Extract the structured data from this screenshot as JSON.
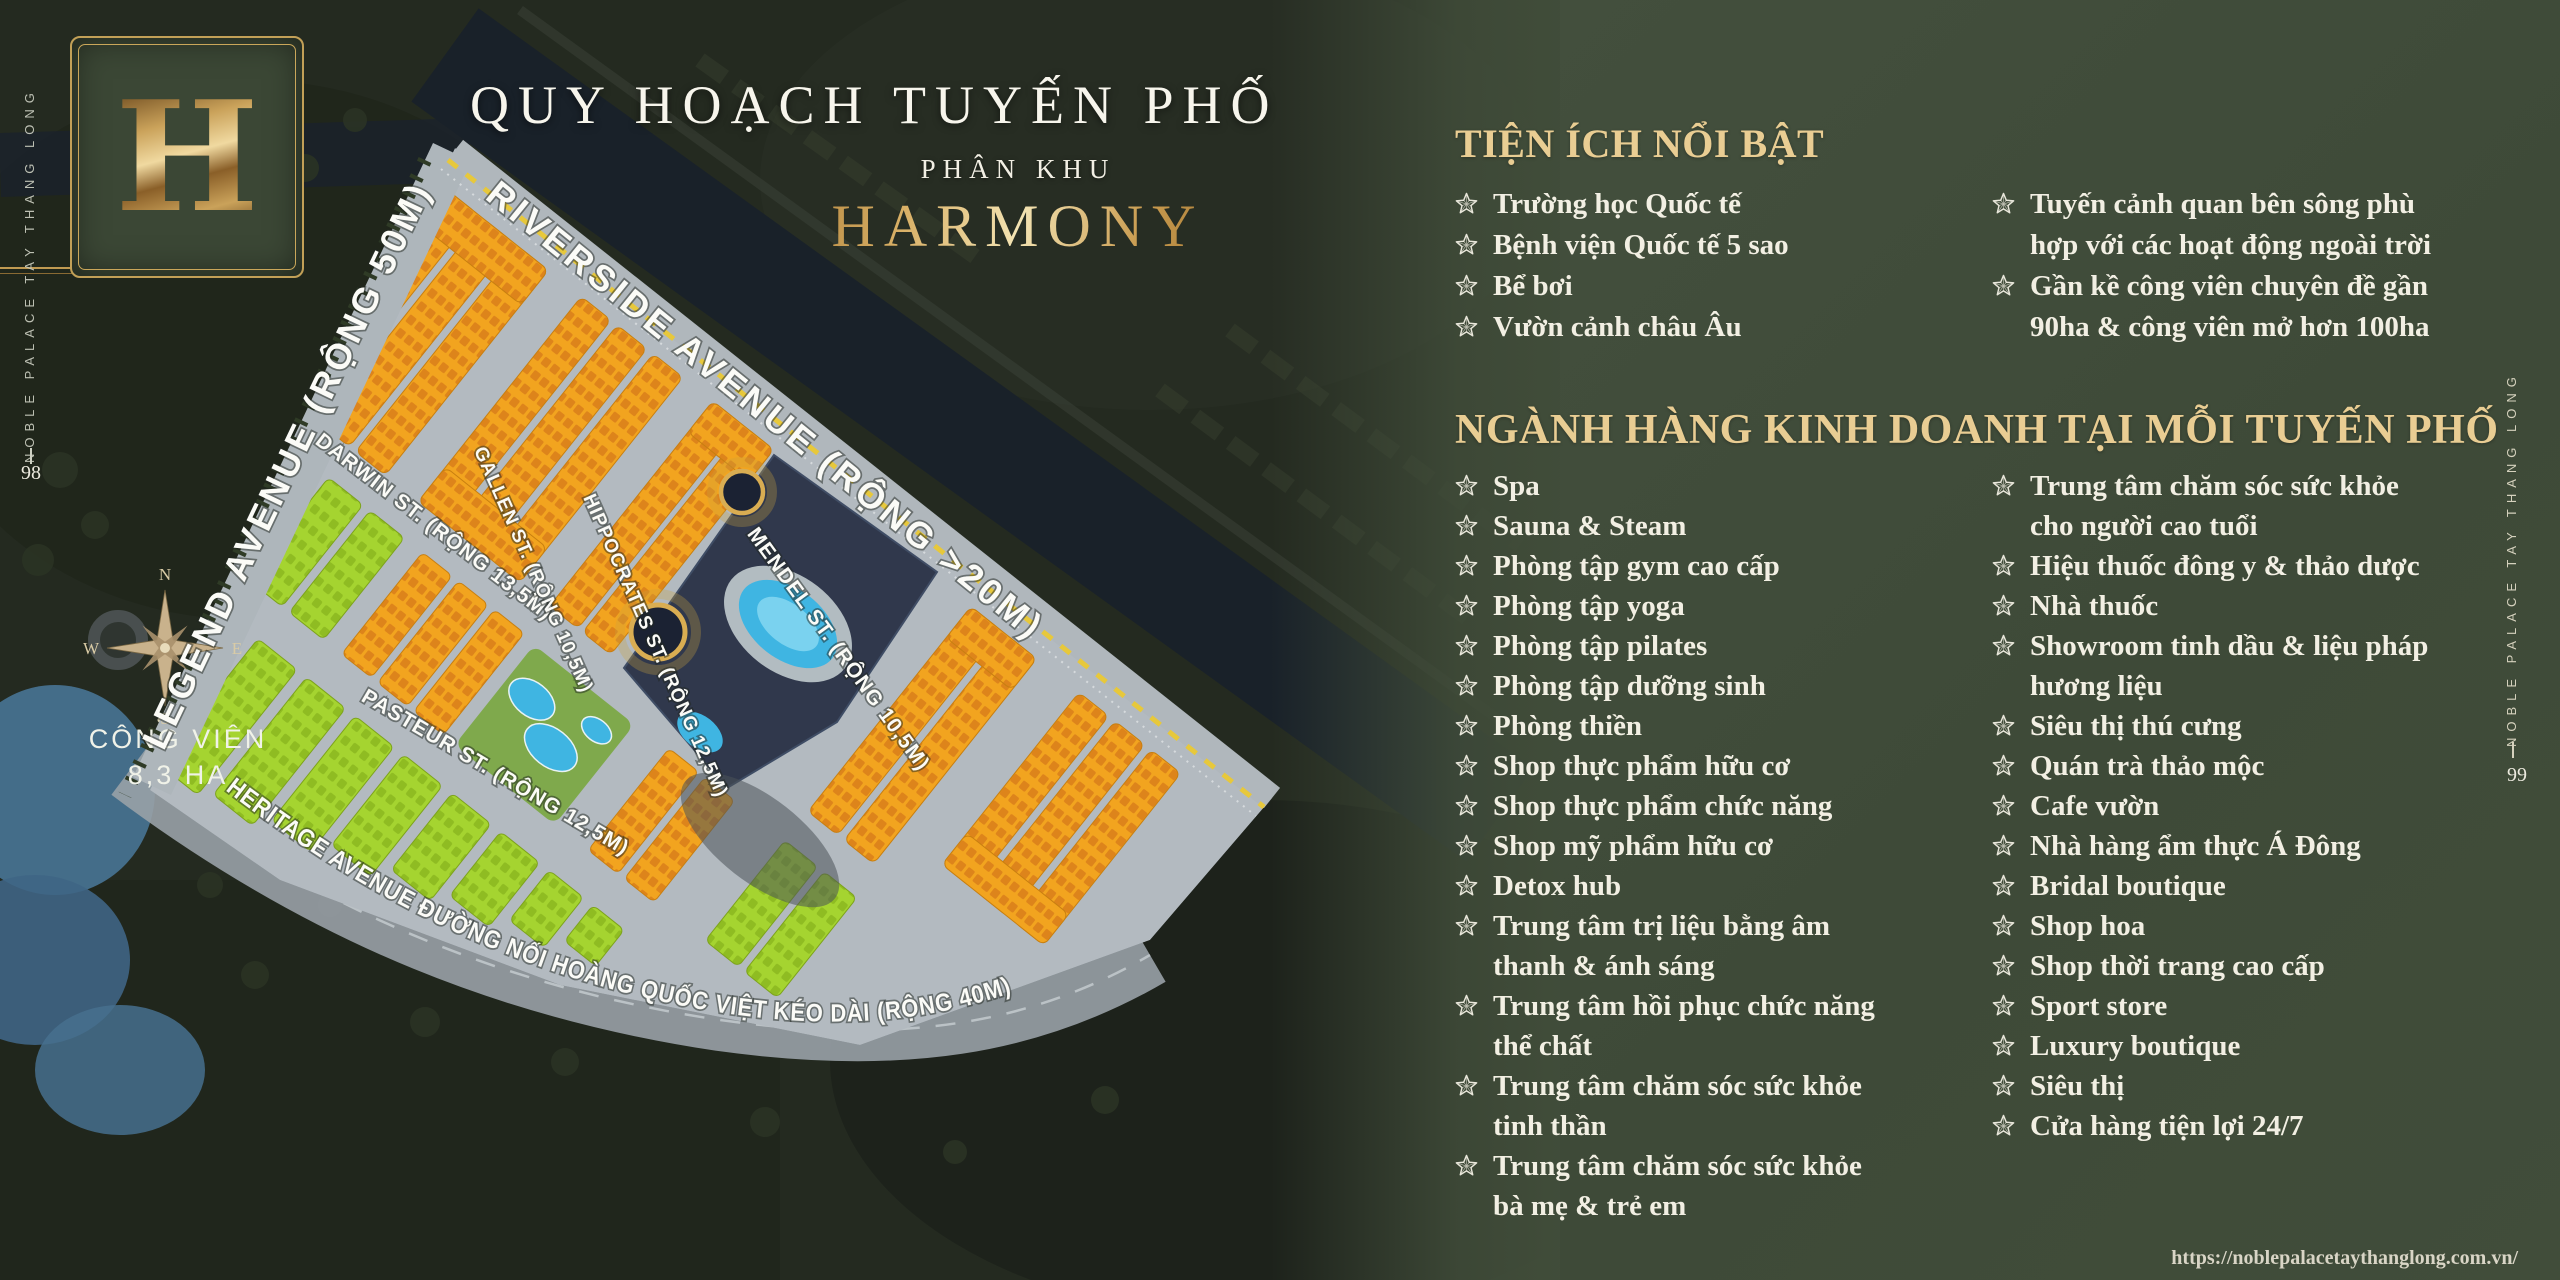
{
  "page": {
    "left_page_number": "98",
    "right_page_number": "99",
    "side_label": "NOBLE PALACE TAY THANG LONG",
    "footer_url": "https://noblepalacetaythanglong.com.vn/"
  },
  "logo": {
    "letter": "H"
  },
  "title": {
    "main": "QUY HOẠCH TUYẾN PHỐ",
    "sub": "PHÂN KHU",
    "zone": "HARMONY"
  },
  "amenities": {
    "header": "TIỆN ÍCH NỔI BẬT",
    "col1": [
      [
        "Trường học Quốc tế"
      ],
      [
        "Bệnh viện Quốc tế 5 sao"
      ],
      [
        "Bể bơi"
      ],
      [
        "Vườn cảnh châu Âu"
      ]
    ],
    "col2": [
      [
        "Tuyến cảnh quan bên sông phù",
        "hợp với các hoạt động ngoài trời"
      ],
      [
        "Gần kề công viên chuyên đề gần",
        "90ha & công viên mở hơn 100ha"
      ]
    ]
  },
  "business": {
    "header": "NGÀNH HÀNG KINH DOANH TẠI MỖI TUYẾN PHỐ",
    "col1": [
      [
        "Spa"
      ],
      [
        "Sauna & Steam"
      ],
      [
        "Phòng tập gym cao cấp"
      ],
      [
        "Phòng tập yoga"
      ],
      [
        "Phòng tập pilates"
      ],
      [
        "Phòng tập dưỡng sinh"
      ],
      [
        "Phòng thiền"
      ],
      [
        "Shop thực phẩm hữu cơ"
      ],
      [
        "Shop thực phẩm chức năng"
      ],
      [
        "Shop mỹ phẩm hữu cơ"
      ],
      [
        "Detox hub"
      ],
      [
        "Trung tâm trị liệu bằng âm",
        "thanh & ánh sáng"
      ],
      [
        "Trung tâm hồi phục chức năng",
        "thể chất"
      ],
      [
        "Trung tâm chăm sóc sức khỏe",
        "tinh thần"
      ],
      [
        "Trung tâm chăm sóc sức khỏe",
        "bà mẹ & trẻ em"
      ]
    ],
    "col2": [
      [
        "Trung tâm chăm sóc sức khỏe",
        "cho người cao tuổi"
      ],
      [
        "Hiệu thuốc đông y & thảo dược"
      ],
      [
        "Nhà thuốc"
      ],
      [
        "Showroom tinh dầu & liệu pháp",
        "hương liệu"
      ],
      [
        "Siêu thị thú cưng"
      ],
      [
        "Quán trà thảo mộc"
      ],
      [
        "Cafe vườn"
      ],
      [
        "Nhà hàng ẩm thực Á Đông"
      ],
      [
        "Bridal boutique"
      ],
      [
        "Shop hoa"
      ],
      [
        "Shop thời trang cao cấp"
      ],
      [
        "Sport store"
      ],
      [
        "Luxury boutique"
      ],
      [
        "Siêu thị"
      ],
      [
        "Cửa hàng tiện lợi 24/7"
      ]
    ]
  },
  "map": {
    "park_label": [
      "CÔNG VIÊN",
      "8,3 HA"
    ],
    "compass": [
      "N",
      "E",
      "S",
      "W"
    ],
    "heritage_label": "HERITAGE AVENUE ĐƯỜNG NỐI HOÀNG QUỐC VIỆT KÉO DÀI (RỘNG 40M)",
    "street_labels": [
      {
        "text": "LEGEND AVENUE (RỘNG 50M)",
        "x": 298,
        "y": 470,
        "rotate": -64.5,
        "size": 36,
        "spacing": 4
      },
      {
        "text": "RIVERSIDE AVENUE (RỘNG >20M)",
        "x": 758,
        "y": 420,
        "rotate": 39,
        "size": 36,
        "spacing": 4
      },
      {
        "text": "DARWIN ST. (RỘNG 13,5M)",
        "x": 430,
        "y": 532,
        "rotate": 37.5,
        "size": 21,
        "spacing": 1
      },
      {
        "text": "GALLEN ST. (RỘNG 10,5M)",
        "x": 528,
        "y": 572,
        "rotate": 66,
        "size": 19,
        "spacing": 1
      },
      {
        "text": "MENDEL ST. (RỘNG 10,5M)",
        "x": 833,
        "y": 653,
        "rotate": 54,
        "size": 21,
        "spacing": 1
      },
      {
        "text": "PASTEUR ST. (RỘNG 12,5M)",
        "x": 492,
        "y": 778,
        "rotate": 30.5,
        "size": 21,
        "spacing": 1
      },
      {
        "text": "HIPPOCRATES ST. (RỘNG 12,5M)",
        "x": 650,
        "y": 648,
        "rotate": 66,
        "size": 19,
        "spacing": 1
      }
    ]
  },
  "colors": {
    "panel_green": "#414d3a",
    "gold_accent": "#e9cd93",
    "block_orange": "#f2a41f",
    "block_lime": "#a5d430"
  }
}
